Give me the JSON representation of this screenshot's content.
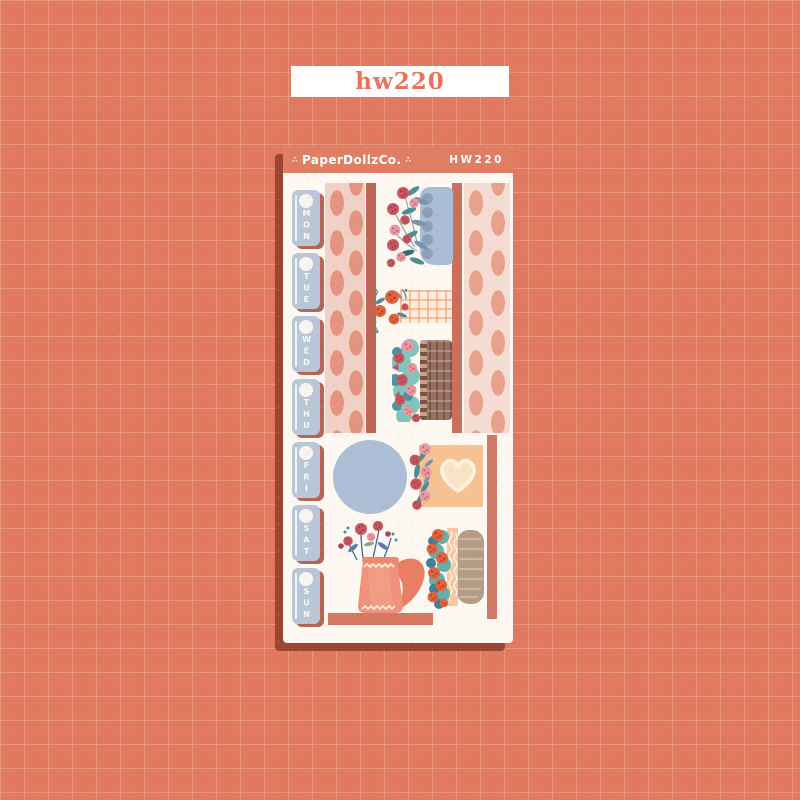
{
  "page": {
    "background_color": "#e0795e",
    "grid_line_color": "#f0a289"
  },
  "top_label": {
    "text": "hw220",
    "text_color": "#e8735a",
    "background_color": "#ffffff"
  },
  "sheet": {
    "brand": "PaperDollzCo.",
    "sku": "HW220",
    "sparkle": "∴",
    "header_color": "#df7e62",
    "paper_color": "#fdf8f2",
    "day_labels": [
      "MON",
      "TUE",
      "WED",
      "THU",
      "FRI",
      "SAT",
      "SUN"
    ],
    "palette": {
      "day_tab_blue": "#b9c6d7",
      "day_tab_shadow": "#b66456",
      "washi_pink": "#f1d0c5",
      "washi_pill": "#e39480",
      "accent_strip": "#bd6653",
      "planter_blue": "#a9bdd5",
      "planter_dot": "#8d9fb6",
      "gingham_cream": "#fdecdc",
      "gingham_orange": "#f29969",
      "basket_brown": "#97705f",
      "leaf_teal": "#4e8f96",
      "leaf_blue": "#7b95af",
      "rose_red": "#c9565e",
      "rose_pink": "#e898a0",
      "rose_orange": "#e0623f",
      "circle_blue": "#abbed6",
      "heart_card_peach": "#f7c291",
      "heart_cream": "#fbe9cf",
      "teapot_coral": "#f0917a",
      "cake_tan": "#b49b86",
      "frosting_peach": "#f6c7a0",
      "shelf_salmon": "#d5785f"
    }
  }
}
